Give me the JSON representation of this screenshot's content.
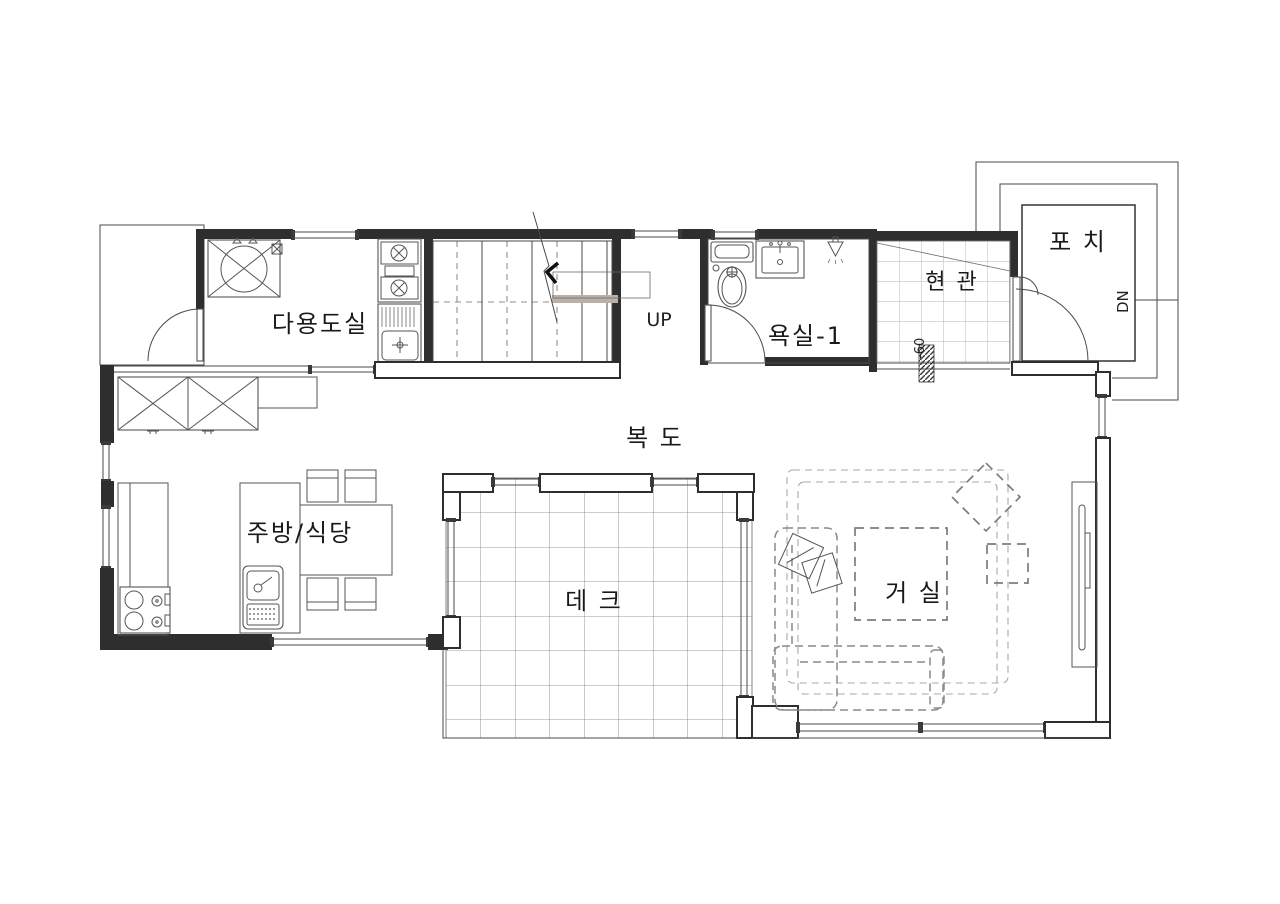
{
  "document": {
    "type": "architectural-floor-plan",
    "floor": "1F",
    "background": "#ffffff"
  },
  "rooms": {
    "utility": "다용도실",
    "bathroom1": "욕실-1",
    "entrance": "현 관",
    "porch": "포 치",
    "corridor": "복 도",
    "kitchen_dining": "주방/식당",
    "deck": "데 크",
    "living": "거 실"
  },
  "annotations": {
    "stairs_up": "UP",
    "porch_down": "DN",
    "entrance_level": "-60"
  },
  "icons": {
    "washing-machine-icon": "square-with-circle-and-x",
    "gas-range-icon": "two-burner-range",
    "utility-sink-icon": "basin-with-drainboard",
    "toilet-icon": "tank-and-bowl",
    "vanity-sink-icon": "rect-basin-with-faucet",
    "shower-icon": "triangle-spray-head",
    "cooktop-icon": "four-burner-cooktop",
    "island-sink-icon": "basin-with-drainboard",
    "dining-table-icon": "table-with-four-chairs",
    "wardrobe-icon": "x-crossed-boxes",
    "sofa-icon": "l-shaped-dashed-sofa",
    "coffee-table-icon": "dashed-square",
    "lounge-chair-icon": "rotated-dashed-square",
    "side-table-icon": "small-dashed-square",
    "tv-icon": "wall-mounted-panel",
    "door-arc-icon": "quarter-circle-swing",
    "stairs-icon": "treads-with-break-line"
  },
  "colors": {
    "wall": "#2e2e2e",
    "line": "#4a4a4a",
    "furniture_dash": "#8a8a8a",
    "rug_dash": "#a8a8a8",
    "landing_fill": "#b9b1a9",
    "text": "#1a1a1a",
    "background": "#ffffff"
  }
}
